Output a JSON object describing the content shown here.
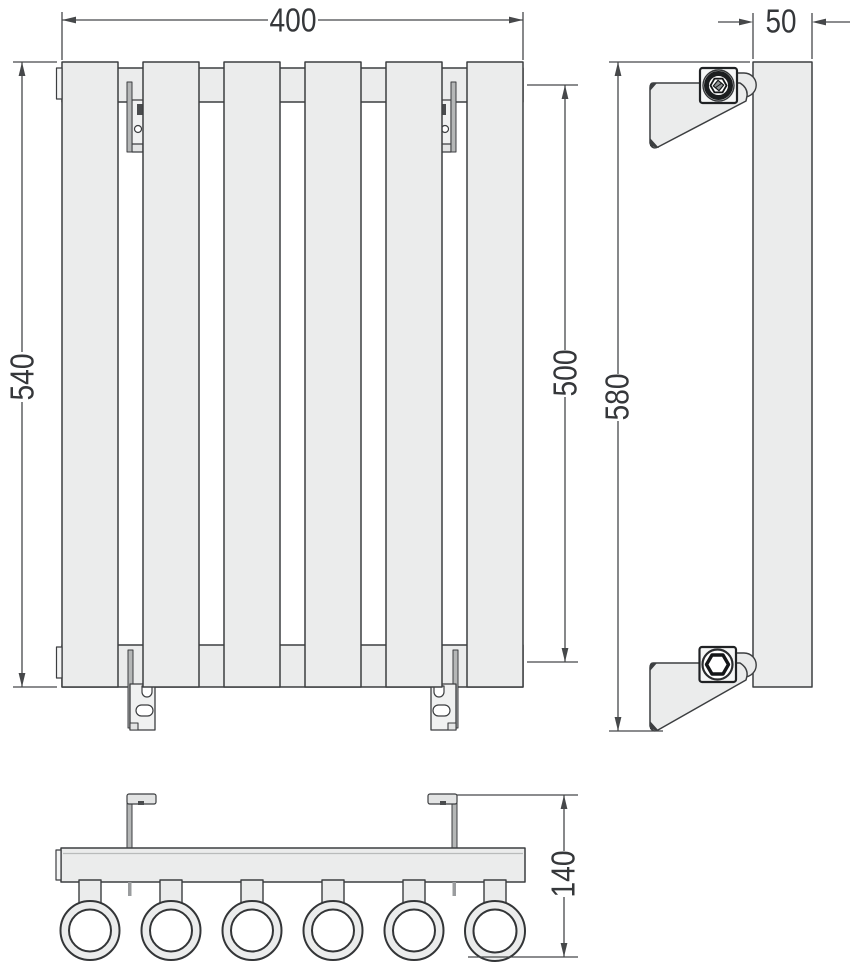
{
  "drawing": {
    "type": "technical-drawing",
    "subject": "vertical panel radiator with wall brackets",
    "dimensions": {
      "front_width": "400",
      "front_overall_height": "540",
      "collector_spacing": "500",
      "panel_depth": "50",
      "side_overall_height": "580",
      "bottom_depth": "140"
    },
    "structure": {
      "panel_count": 6,
      "tube_count": 6,
      "bracket_count": 4
    },
    "colors": {
      "panel_fill": "#ebecec",
      "outline": "#3c3e40",
      "dimension_line": "#46484a",
      "text": "#35373a",
      "background": "#ffffff"
    }
  }
}
